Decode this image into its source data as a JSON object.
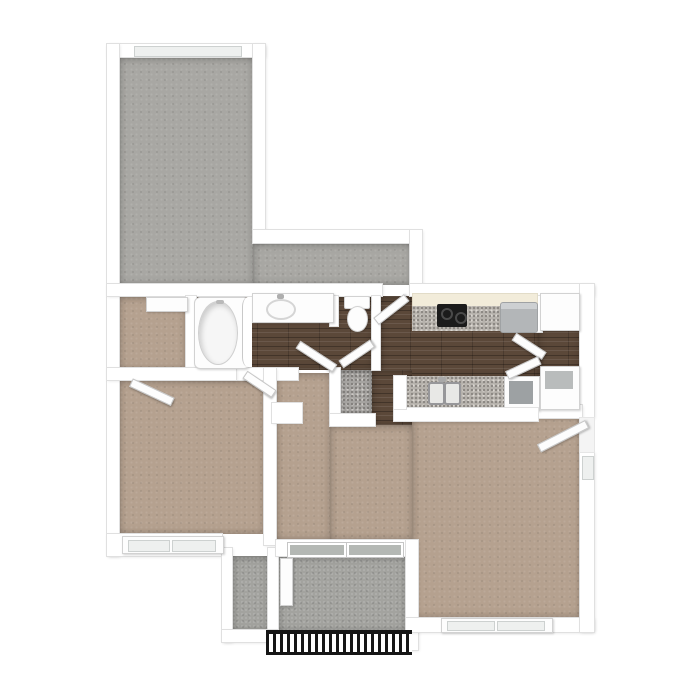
{
  "scene": {
    "description": "3D top-down rendered apartment floor plan on a white background",
    "background": "#ffffff"
  },
  "palette": {
    "wall_white": "#ffffff",
    "wall_edge": "#e0e0e0",
    "carpet_gray": "#a8a7a3",
    "carpet_tan": "#b5a18f",
    "wood_floor": "#5b4839",
    "entry_tile": "#a6a4a1",
    "granite_counter": "#b6b2ac",
    "concrete_balcony": "#a3a39f",
    "cream_cabinets": "#f2ecda",
    "appliance_gray": "#b3b6b8",
    "stove_black": "#1b1b1b",
    "railing_black": "#161616",
    "glass_dark": "#b4b8b4",
    "glass_light": "#eef0ef"
  },
  "rooms": {
    "bonus": {
      "name": "L-shaped gray carpeted room"
    },
    "closet": {
      "name": "Closet with shelf (tan carpet)"
    },
    "bathroom": {
      "name": "Bathroom with tub and vanity (wood floor)"
    },
    "water_closet": {
      "name": "Toilet room (wood floor)"
    },
    "kitchen": {
      "name": "Kitchen (wood floor)"
    },
    "pantry": {
      "name": "Laundry / pantry closet (wood floor)"
    },
    "entry_tile": {
      "name": "Tiled entry nook"
    },
    "bedroom": {
      "name": "Bedroom (tan carpet)"
    },
    "hall": {
      "name": "Hallway (tan carpet)"
    },
    "living": {
      "name": "Living / dining room (tan carpet)"
    },
    "balcony": {
      "name": "Balcony with railing (concrete)"
    },
    "storage": {
      "name": "Exterior storage closet"
    }
  },
  "fixtures": {
    "tub": "bathtub with shower curtain",
    "vanity": "vanity counter with oval sink",
    "toilet": "toilet",
    "stove": "black cooktop range",
    "fridge": "refrigerator",
    "kitchen_sink": "double-basin kitchen sink in granite peninsula",
    "washer": "white appliance (top of laundry closet)",
    "dryer": "white appliance (bottom of laundry closet)",
    "shelf": "closet shelf",
    "railing": "black balcony railing"
  },
  "openings": {
    "doors": [
      "bonus-room-to-kitchen door",
      "laundry bifold doors",
      "bathroom door",
      "toilet-room door",
      "bedroom closet door",
      "bedroom door",
      "apartment entry door",
      "balcony door leaf"
    ],
    "windows": [
      "bonus room top window",
      "bedroom double window",
      "living room double window",
      "balcony sliding windows",
      "side window at entry"
    ]
  }
}
